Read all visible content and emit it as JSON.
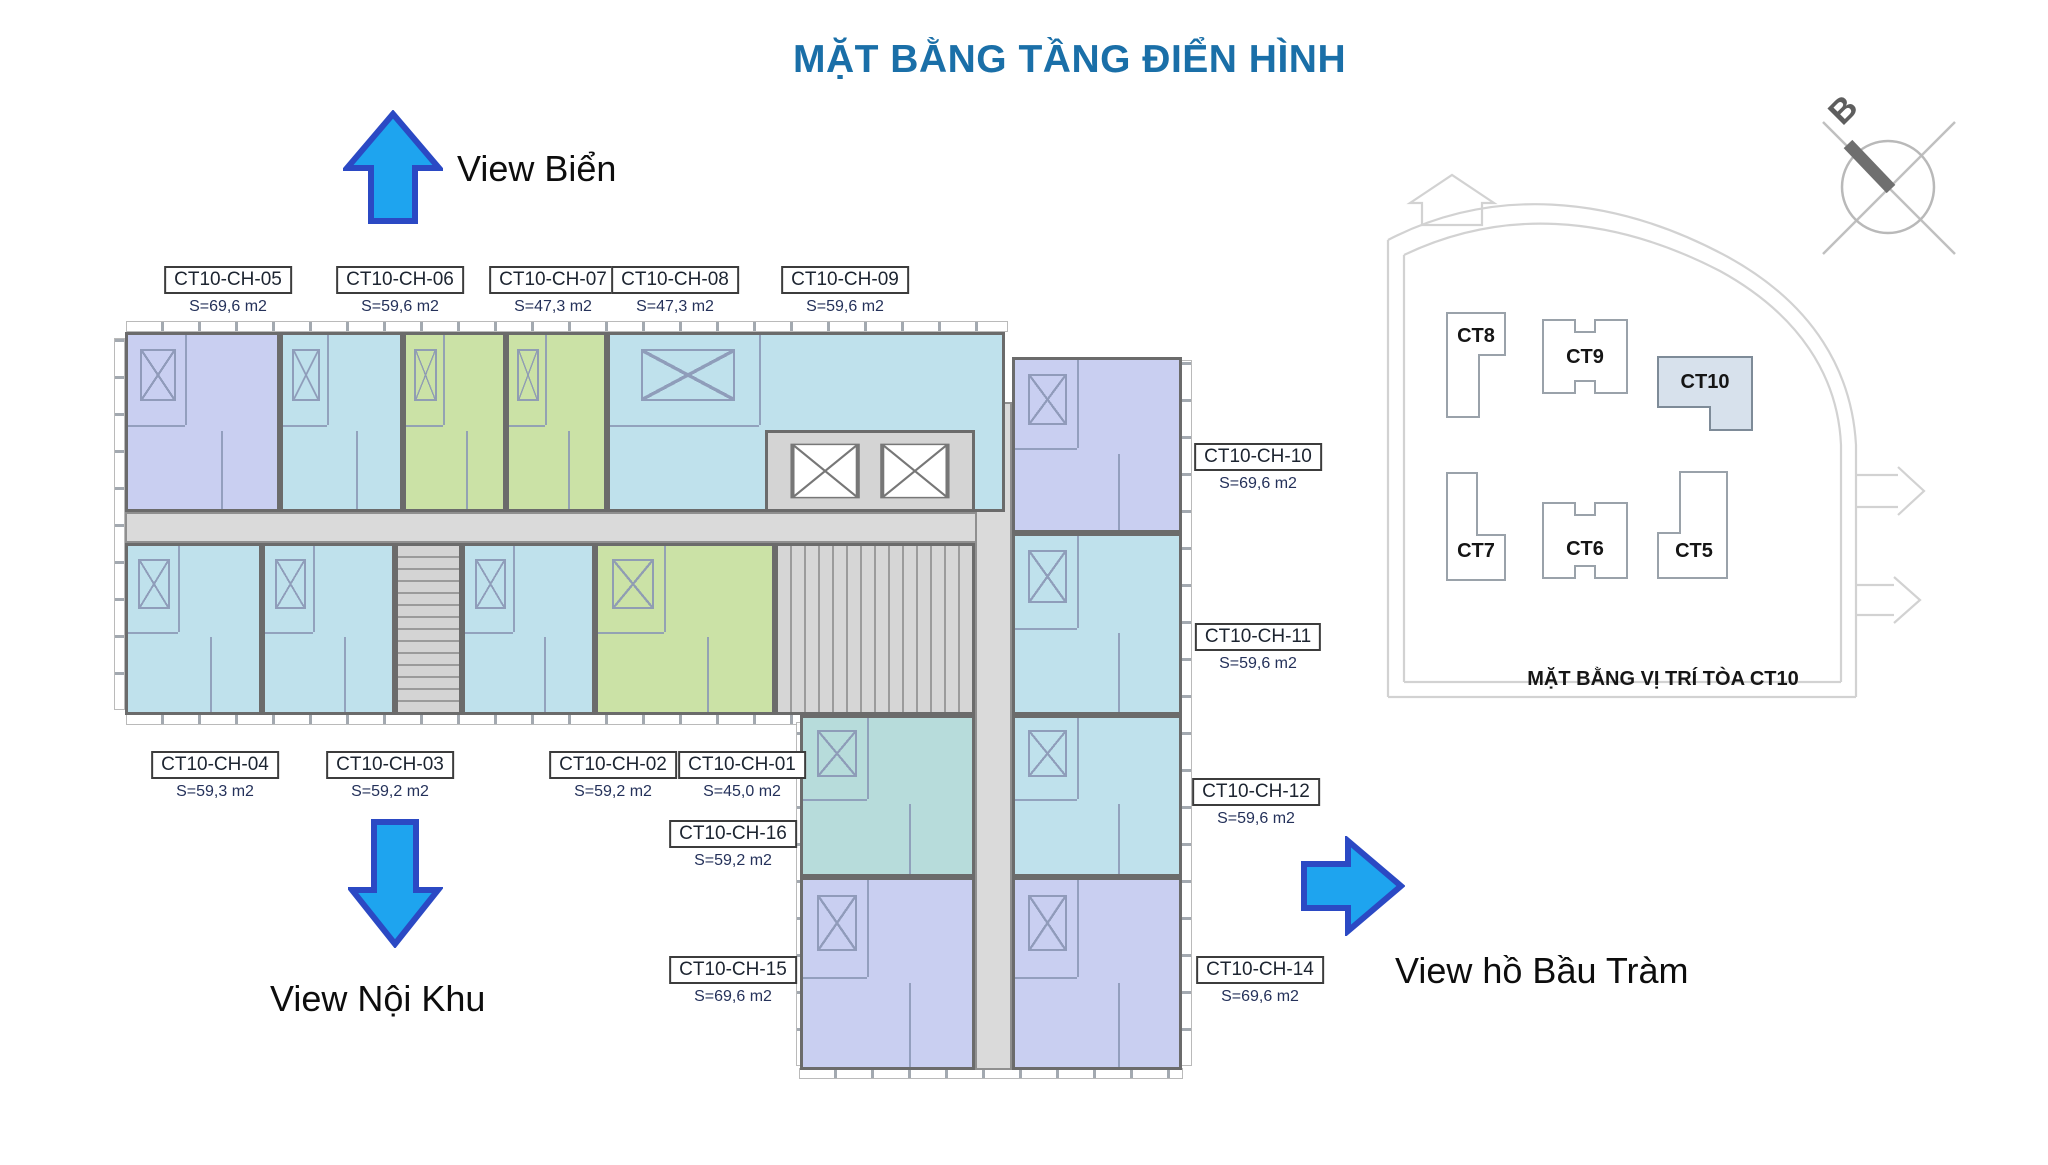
{
  "title": "MẶT BẰNG TẦNG ĐIỂN HÌNH",
  "views": {
    "top": "View Biển",
    "bottom": "View Nội Khu",
    "right": "View hồ Bầu Tràm"
  },
  "units": [
    {
      "id": "CT10-CH-05",
      "area": "S=69,6 m2",
      "type": "purple"
    },
    {
      "id": "CT10-CH-06",
      "area": "S=59,6 m2",
      "type": "cyan"
    },
    {
      "id": "CT10-CH-07",
      "area": "S=47,3 m2",
      "type": "green"
    },
    {
      "id": "CT10-CH-08",
      "area": "S=47,3 m2",
      "type": "green"
    },
    {
      "id": "CT10-CH-09",
      "area": "S=59,6 m2",
      "type": "cyan"
    },
    {
      "id": "CT10-CH-10",
      "area": "S=69,6 m2",
      "type": "purple"
    },
    {
      "id": "CT10-CH-11",
      "area": "S=59,6 m2",
      "type": "cyan"
    },
    {
      "id": "CT10-CH-12",
      "area": "S=59,6 m2",
      "type": "cyan"
    },
    {
      "id": "CT10-CH-14",
      "area": "S=69,6 m2",
      "type": "purple"
    },
    {
      "id": "CT10-CH-04",
      "area": "S=59,3 m2",
      "type": "cyan"
    },
    {
      "id": "CT10-CH-03",
      "area": "S=59,2 m2",
      "type": "cyan"
    },
    {
      "id": "CT10-CH-02",
      "area": "S=59,2 m2",
      "type": "cyan"
    },
    {
      "id": "CT10-CH-01",
      "area": "S=45,0 m2",
      "type": "green"
    },
    {
      "id": "CT10-CH-16",
      "area": "S=59,2 m2",
      "type": "teal"
    },
    {
      "id": "CT10-CH-15",
      "area": "S=69,6 m2",
      "type": "purple"
    }
  ],
  "site_map": {
    "caption": "MẶT BẰNG VỊ TRÍ TÒA CT10",
    "buildings": [
      "CT8",
      "CT9",
      "CT10",
      "CT7",
      "CT6",
      "CT5"
    ],
    "highlighted": "CT10",
    "compass_label": "B"
  },
  "colors": {
    "title_blue": "#1a6fa8",
    "arrow_fill": "#1ea4ef",
    "arrow_stroke": "#2b49c4",
    "unit_purple": "#c9cff1",
    "unit_cyan": "#bfe1ec",
    "unit_teal": "#b7dcdb",
    "unit_green": "#cbe2a6",
    "corridor_gray": "#dadada",
    "wall_gray": "#6b6b6b"
  }
}
